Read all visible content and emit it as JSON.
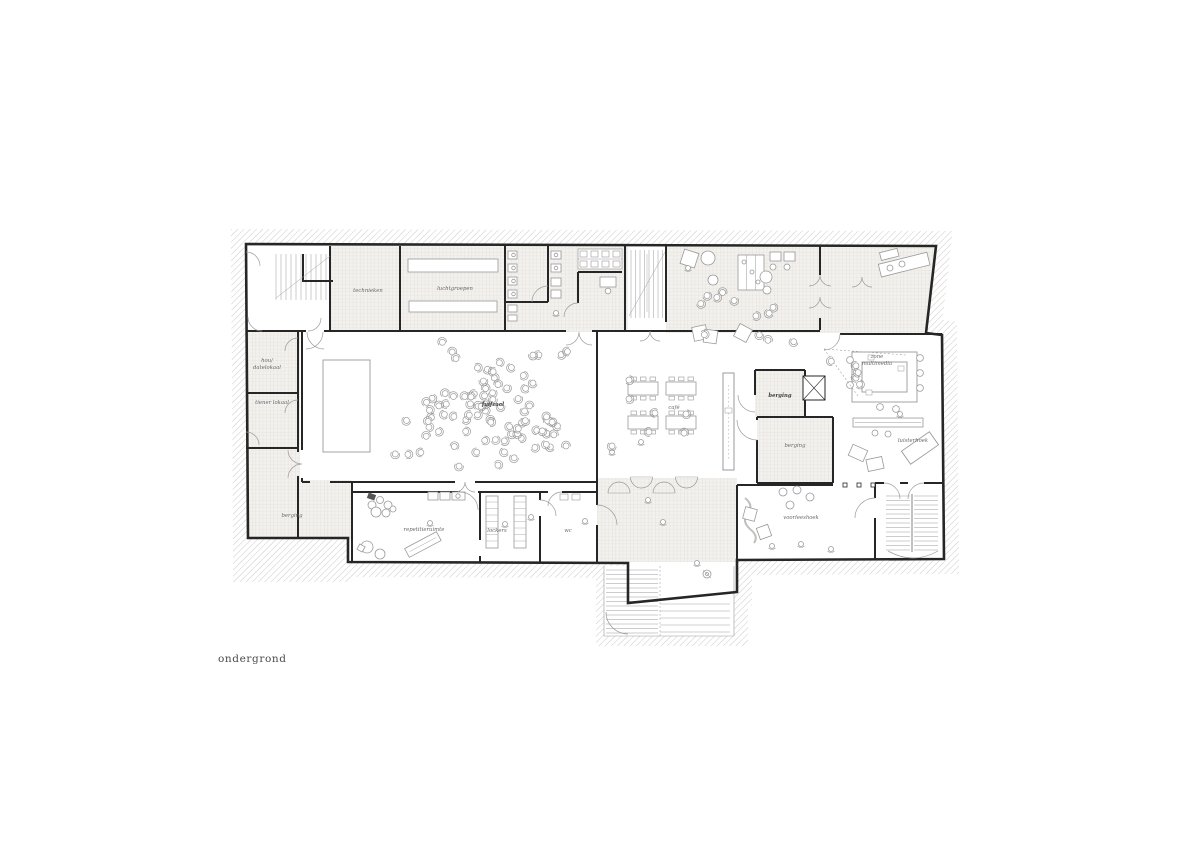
{
  "drawing": {
    "caption": "ondergrond"
  },
  "rooms": {
    "technieken": {
      "label": "technieken"
    },
    "luchtgroepen": {
      "label": "luchtgroepen"
    },
    "hal": {
      "line1": "hou/",
      "line2": "datelokaal"
    },
    "tienerlokaal": {
      "label": "tiener lokaal"
    },
    "berging_west": {
      "label": "berging"
    },
    "fuifzaal": {
      "label": "fuifzaal"
    },
    "cafe": {
      "label": "café"
    },
    "berging_small": {
      "label": "berging"
    },
    "berging_large": {
      "label": "berging"
    },
    "multimedia": {
      "line1": "zone",
      "line2": "multimedia"
    },
    "luisterhoek": {
      "label": "luisterhoek"
    },
    "repetitieruimte": {
      "label": "repetitieruimte"
    },
    "lockers": {
      "label": "lockers"
    },
    "wc": {
      "label": "wc"
    },
    "voorleeshoek": {
      "label": "voorleeshoek"
    }
  },
  "colors": {
    "background": "#ffffff",
    "wall": "#262626",
    "hatch_line": "#b8b5b1",
    "tile_bg": "#f3f1ee",
    "tile_line": "#ddd8d1",
    "furniture_line": "#9a9a9a",
    "label_text": "#6a6a6a",
    "caption_text": "#4a4a4a"
  }
}
